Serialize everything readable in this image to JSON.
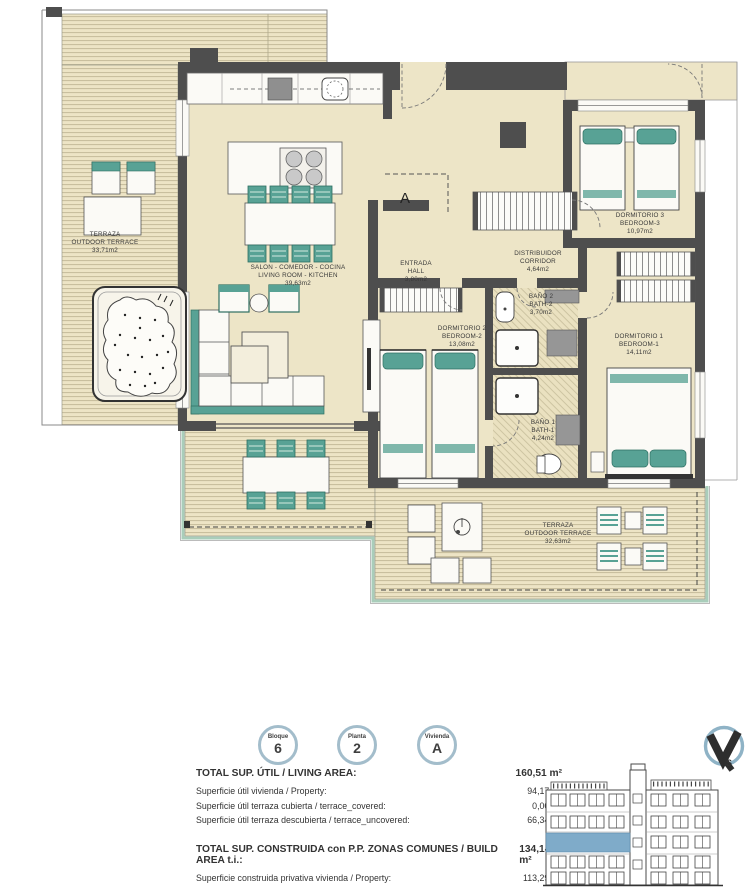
{
  "plan": {
    "marker_letter": "A",
    "compass_label": "S",
    "rooms": {
      "salon": {
        "name_es": "SALON - COMEDOR - COCINA",
        "name_en": "LIVING ROOM - KITCHEN",
        "area": "39,63m2"
      },
      "entrada": {
        "name_es": "ENTRADA",
        "name_en": "HALL",
        "area": "3,80m2"
      },
      "distribuidor": {
        "name_es": "DISTRIBUIDOR",
        "name_en": "CORRIDOR",
        "area": "4,64m2"
      },
      "dormitorio1": {
        "name_es": "DORMITORIO 1",
        "name_en": "BEDROOM-1",
        "area": "14,11m2"
      },
      "dormitorio2": {
        "name_es": "DORMITORIO 2",
        "name_en": "BEDROOM-2",
        "area": "13,08m2"
      },
      "dormitorio3": {
        "name_es": "DORMITORIO 3",
        "name_en": "BEDROOM-3",
        "area": "10,97m2"
      },
      "bano1": {
        "name_es": "BAÑO 1",
        "name_en": "BATH-1",
        "area": "4,24m2"
      },
      "bano2": {
        "name_es": "BAÑO 2",
        "name_en": "BATH-2",
        "area": "3,70m2"
      },
      "terraza_oeste": {
        "name_es": "TERRAZA",
        "name_en": "OUTDOOR TERRACE",
        "area": "33,71m2"
      },
      "terraza_sur": {
        "name_es": "TERRAZA",
        "name_en": "OUTDOOR TERRACE",
        "area": "32,63m2"
      }
    }
  },
  "badges": [
    {
      "label": "Bloque",
      "value": "6"
    },
    {
      "label": "Planta",
      "value": "2"
    },
    {
      "label": "Vivienda",
      "value": "A"
    }
  ],
  "summary": {
    "sections": [
      {
        "header": {
          "label": "TOTAL SUP. ÚTIL / LIVING AREA:",
          "value": "160,51 m²"
        },
        "rows": [
          {
            "label": "Superficie útil vivienda / Property:",
            "value": "94,17 m²"
          },
          {
            "label": "Superficie útil terraza cubierta / terrace_covered:",
            "value": "0,00 m²"
          },
          {
            "label": "Superficie útil terraza descubierta / terrace_uncovered:",
            "value": "66,34 m²"
          }
        ]
      },
      {
        "header": {
          "label": "TOTAL SUP. CONSTRUIDA con P.P. ZONAS COMUNES / BUILD AREA t.i.:",
          "value": "134,14 m²"
        },
        "rows": [
          {
            "label": "Superficie construida privativa vivienda / Property:",
            "value": "113,29 m²"
          }
        ]
      }
    ]
  },
  "colors": {
    "floor": "#EDE5C7",
    "wall": "#4E4E4E",
    "furniture_teal": "#58A295",
    "terrace_edge": "#A9CDBA",
    "badge_ring": "#A3BDCB",
    "elevation_highlight": "#7FABC9"
  }
}
